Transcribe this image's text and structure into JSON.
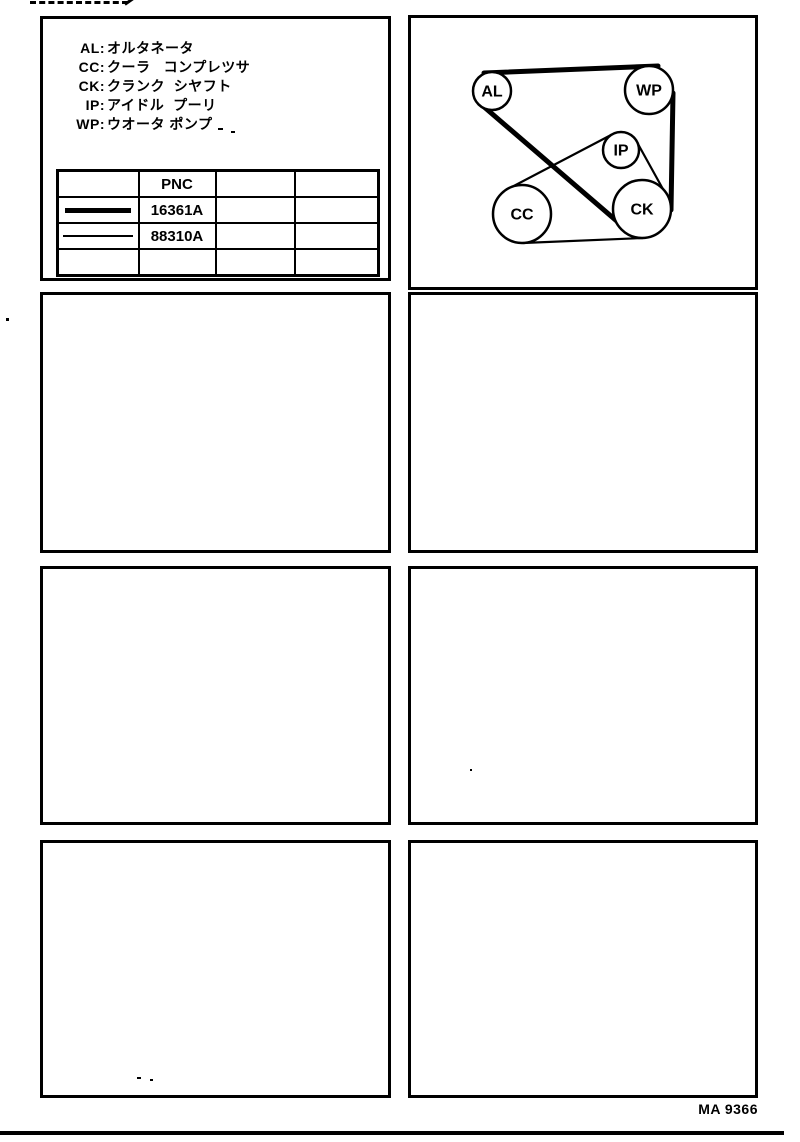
{
  "page": {
    "footer_code": "MA 9366"
  },
  "legend": {
    "entries": [
      {
        "abbr": "AL:",
        "meaning": "オルタネータ"
      },
      {
        "abbr": "CC:",
        "meaning": "クーラ   コンプレツサ"
      },
      {
        "abbr": "CK:",
        "meaning": "クランク  シヤフト"
      },
      {
        "abbr": "IP:",
        "meaning": "アイドル  プーリ"
      },
      {
        "abbr": "WP:",
        "meaning": "ウオータ ポンプ"
      }
    ]
  },
  "parts_table": {
    "columns": [
      "",
      "PNC",
      "",
      ""
    ],
    "rows": [
      {
        "belt_line": "thick",
        "pnc": "16361A"
      },
      {
        "belt_line": "thin",
        "pnc": "88310A"
      },
      {
        "belt_line": "",
        "pnc": ""
      }
    ]
  },
  "belt_diagram": {
    "pulleys": [
      {
        "id": "AL",
        "label": "AL",
        "cx": 81,
        "cy": 73,
        "r": 19
      },
      {
        "id": "WP",
        "label": "WP",
        "cx": 238,
        "cy": 72,
        "r": 24
      },
      {
        "id": "IP",
        "label": "IP",
        "cx": 210,
        "cy": 132,
        "r": 18
      },
      {
        "id": "CC",
        "label": "CC",
        "cx": 111,
        "cy": 196,
        "r": 29
      },
      {
        "id": "CK",
        "label": "CK",
        "cx": 231,
        "cy": 191,
        "r": 29
      }
    ],
    "belts": [
      {
        "pnc": "16361A",
        "line": "thick",
        "route": "AL-WP-CK"
      },
      {
        "pnc": "88310A",
        "line": "thin",
        "route": "CC-IP-CK"
      }
    ]
  },
  "ink_color": "#000000",
  "paper_color": "#ffffff"
}
